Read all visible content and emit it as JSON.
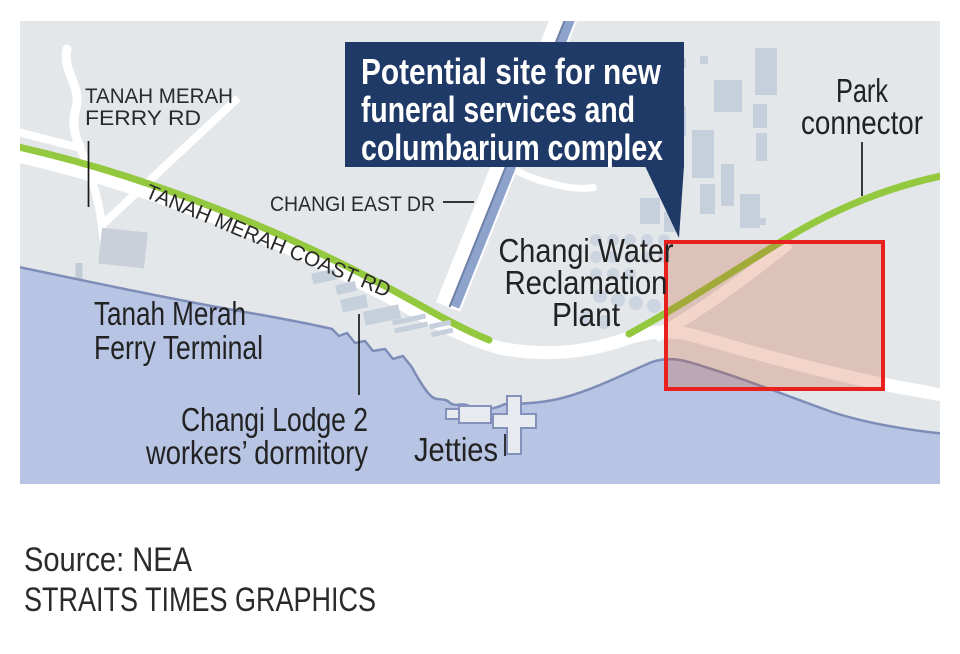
{
  "callout": {
    "line1": "Potential site for new",
    "line2": "funeral services and",
    "line3": "columbarium complex"
  },
  "road_labels": {
    "ferry_rd_1": "TANAH MERAH",
    "ferry_rd_2": "FERRY RD",
    "coast_rd": "TANAH MERAH COAST RD",
    "changi_east_dr": "CHANGI EAST DR"
  },
  "place_labels": {
    "ferry_terminal_1": "Tanah Merah",
    "ferry_terminal_2": "Ferry Terminal",
    "reclamation_1": "Changi Water",
    "reclamation_2": "Reclamation",
    "reclamation_3": "Plant",
    "lodge_1": "Changi Lodge 2",
    "lodge_2": "workers’ dormitory",
    "jetties": "Jetties",
    "park_1": "Park",
    "park_2": "connector"
  },
  "source": {
    "line1": "Source: NEA",
    "line2": "STRAITS TIMES GRAPHICS"
  },
  "colors": {
    "land": "#e3e7ea",
    "water": "#b7c4e3",
    "coastline": "#7e8db7",
    "road": "#ffffff",
    "green_road": "#94c83e",
    "canal": "#8da3cc",
    "building": "#c6cfdc",
    "callout_bg": "#1f3a66",
    "callout_text": "#ffffff",
    "highlight_border": "#e8201e",
    "highlight_fill": "rgba(206,88,48,0.26)",
    "label_text": "#2a2a2a"
  }
}
